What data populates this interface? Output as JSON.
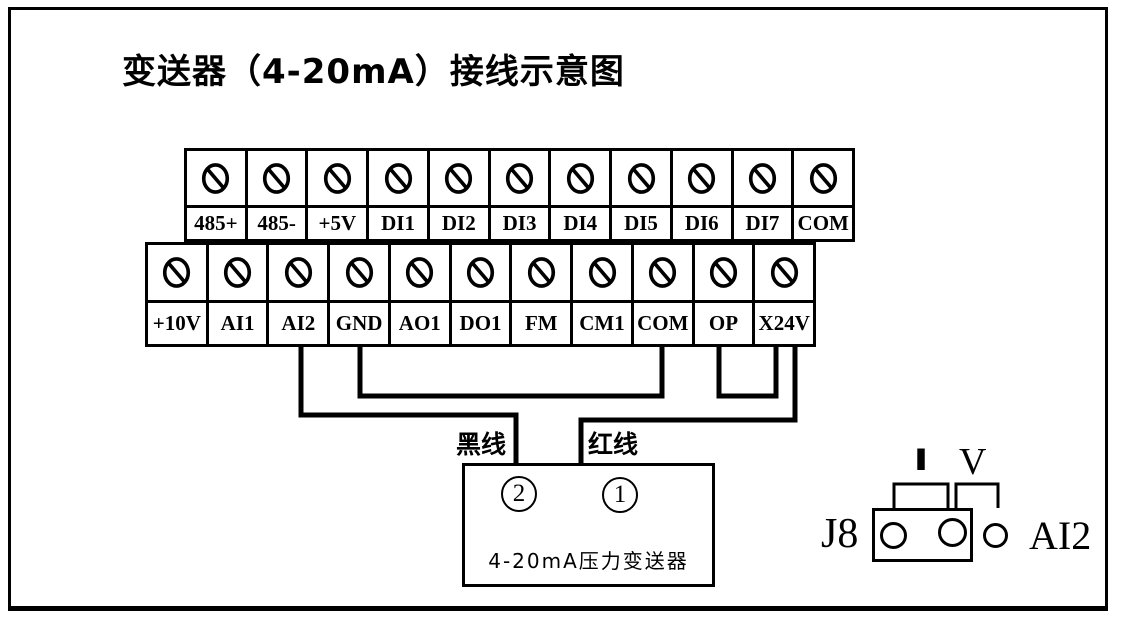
{
  "title": "变送器（4-20mA）接线示意图",
  "terminal_blocks": {
    "top": {
      "labels": [
        "485+",
        "485-",
        "+5V",
        "DI1",
        "DI2",
        "DI3",
        "DI4",
        "DI5",
        "DI6",
        "DI7",
        "COM"
      ]
    },
    "bottom": {
      "labels": [
        "+10V",
        "AI1",
        "AI2",
        "GND",
        "AO1",
        "DO1",
        "FM",
        "CM1",
        "COM",
        "OP",
        "X24V"
      ]
    }
  },
  "wires": {
    "black_wire_label": "黑线",
    "red_wire_label": "红线",
    "connections": [
      {
        "from": "AI2",
        "to": "transmitter-terminal-2",
        "label": "黑线"
      },
      {
        "from": "GND",
        "to": "COM"
      },
      {
        "from": "OP",
        "to": "X24V"
      },
      {
        "from": "X24V",
        "to": "transmitter-terminal-1",
        "label": "红线"
      }
    ]
  },
  "transmitter": {
    "terminal_2": "2",
    "terminal_1": "1",
    "label": "4-20mA压力变送器"
  },
  "jumper": {
    "connector_label": "J8",
    "current_position_label": "I",
    "voltage_position_label": "V",
    "signal_label": "AI2"
  },
  "icons": {
    "screw_terminal": "circle-with-diagonal-slash screw head"
  },
  "colors": {
    "ink": "#000000",
    "background": "#ffffff"
  }
}
